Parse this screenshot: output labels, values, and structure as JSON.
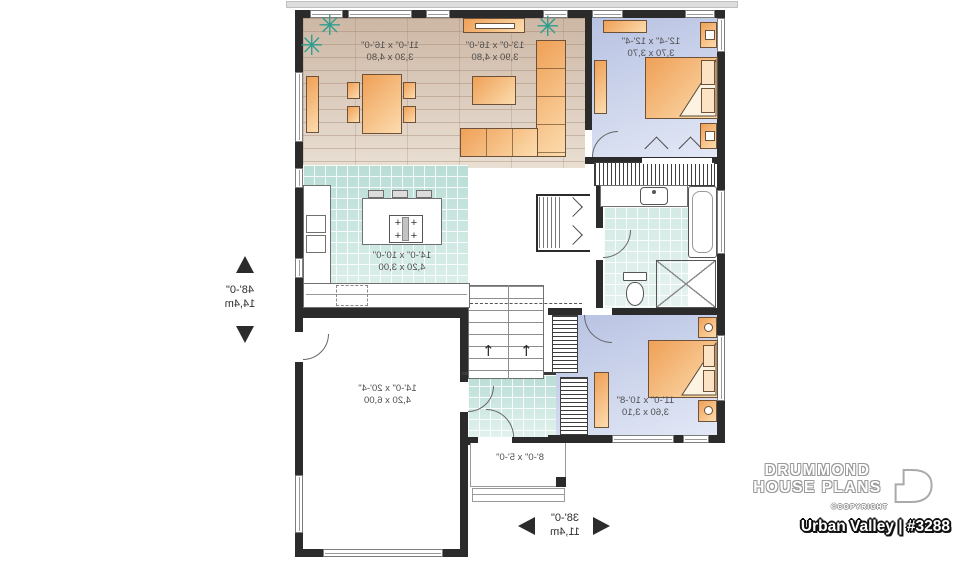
{
  "branding": {
    "name_line1": "DRUMMOND",
    "name_line2": "HOUSE PLANS",
    "copyright": "©COPYRIGHT",
    "plan_title": "Urban Valley | #3288"
  },
  "overall_dimensions": {
    "depth_ft": "48'-0\"",
    "depth_m": "14,4m",
    "width_ft": "38'-0\"",
    "width_m": "11,4m"
  },
  "rooms": {
    "dining": {
      "size_ft": "11'-0\" x 16'-0\"",
      "size_m": "3,30 x 4,80"
    },
    "living": {
      "size_ft": "13'-0\" x 16'-0\"",
      "size_m": "3,90 x 4,80"
    },
    "bedroom1": {
      "size_ft": "12'-4\" x 12'-4\"",
      "size_m": "3,70 x 3,70"
    },
    "kitchen": {
      "size_ft": "14'-0\" x 10'-0\"",
      "size_m": "4,20 x 3,00"
    },
    "garage": {
      "size_ft": "14'-0\" x 20'-4\"",
      "size_m": "4,20 x 6,00"
    },
    "bedroom2": {
      "size_ft": "11'-0\" x 10'-8\"",
      "size_m": "3,60 x 3,10"
    },
    "porch": {
      "size_ft": "8'-0\" x 5'-0\""
    }
  },
  "icons": {
    "plant": "✳",
    "arrow_up": "↑",
    "burner": "+"
  },
  "colors": {
    "wall": "#2b2b2b",
    "wood_floor": "#d8c4b3",
    "bedroom_floor": "#c3cde8",
    "tile_floor": "#c3e4de",
    "furniture_orange": "#f2a35c",
    "plant_green": "#2f9e8f"
  }
}
